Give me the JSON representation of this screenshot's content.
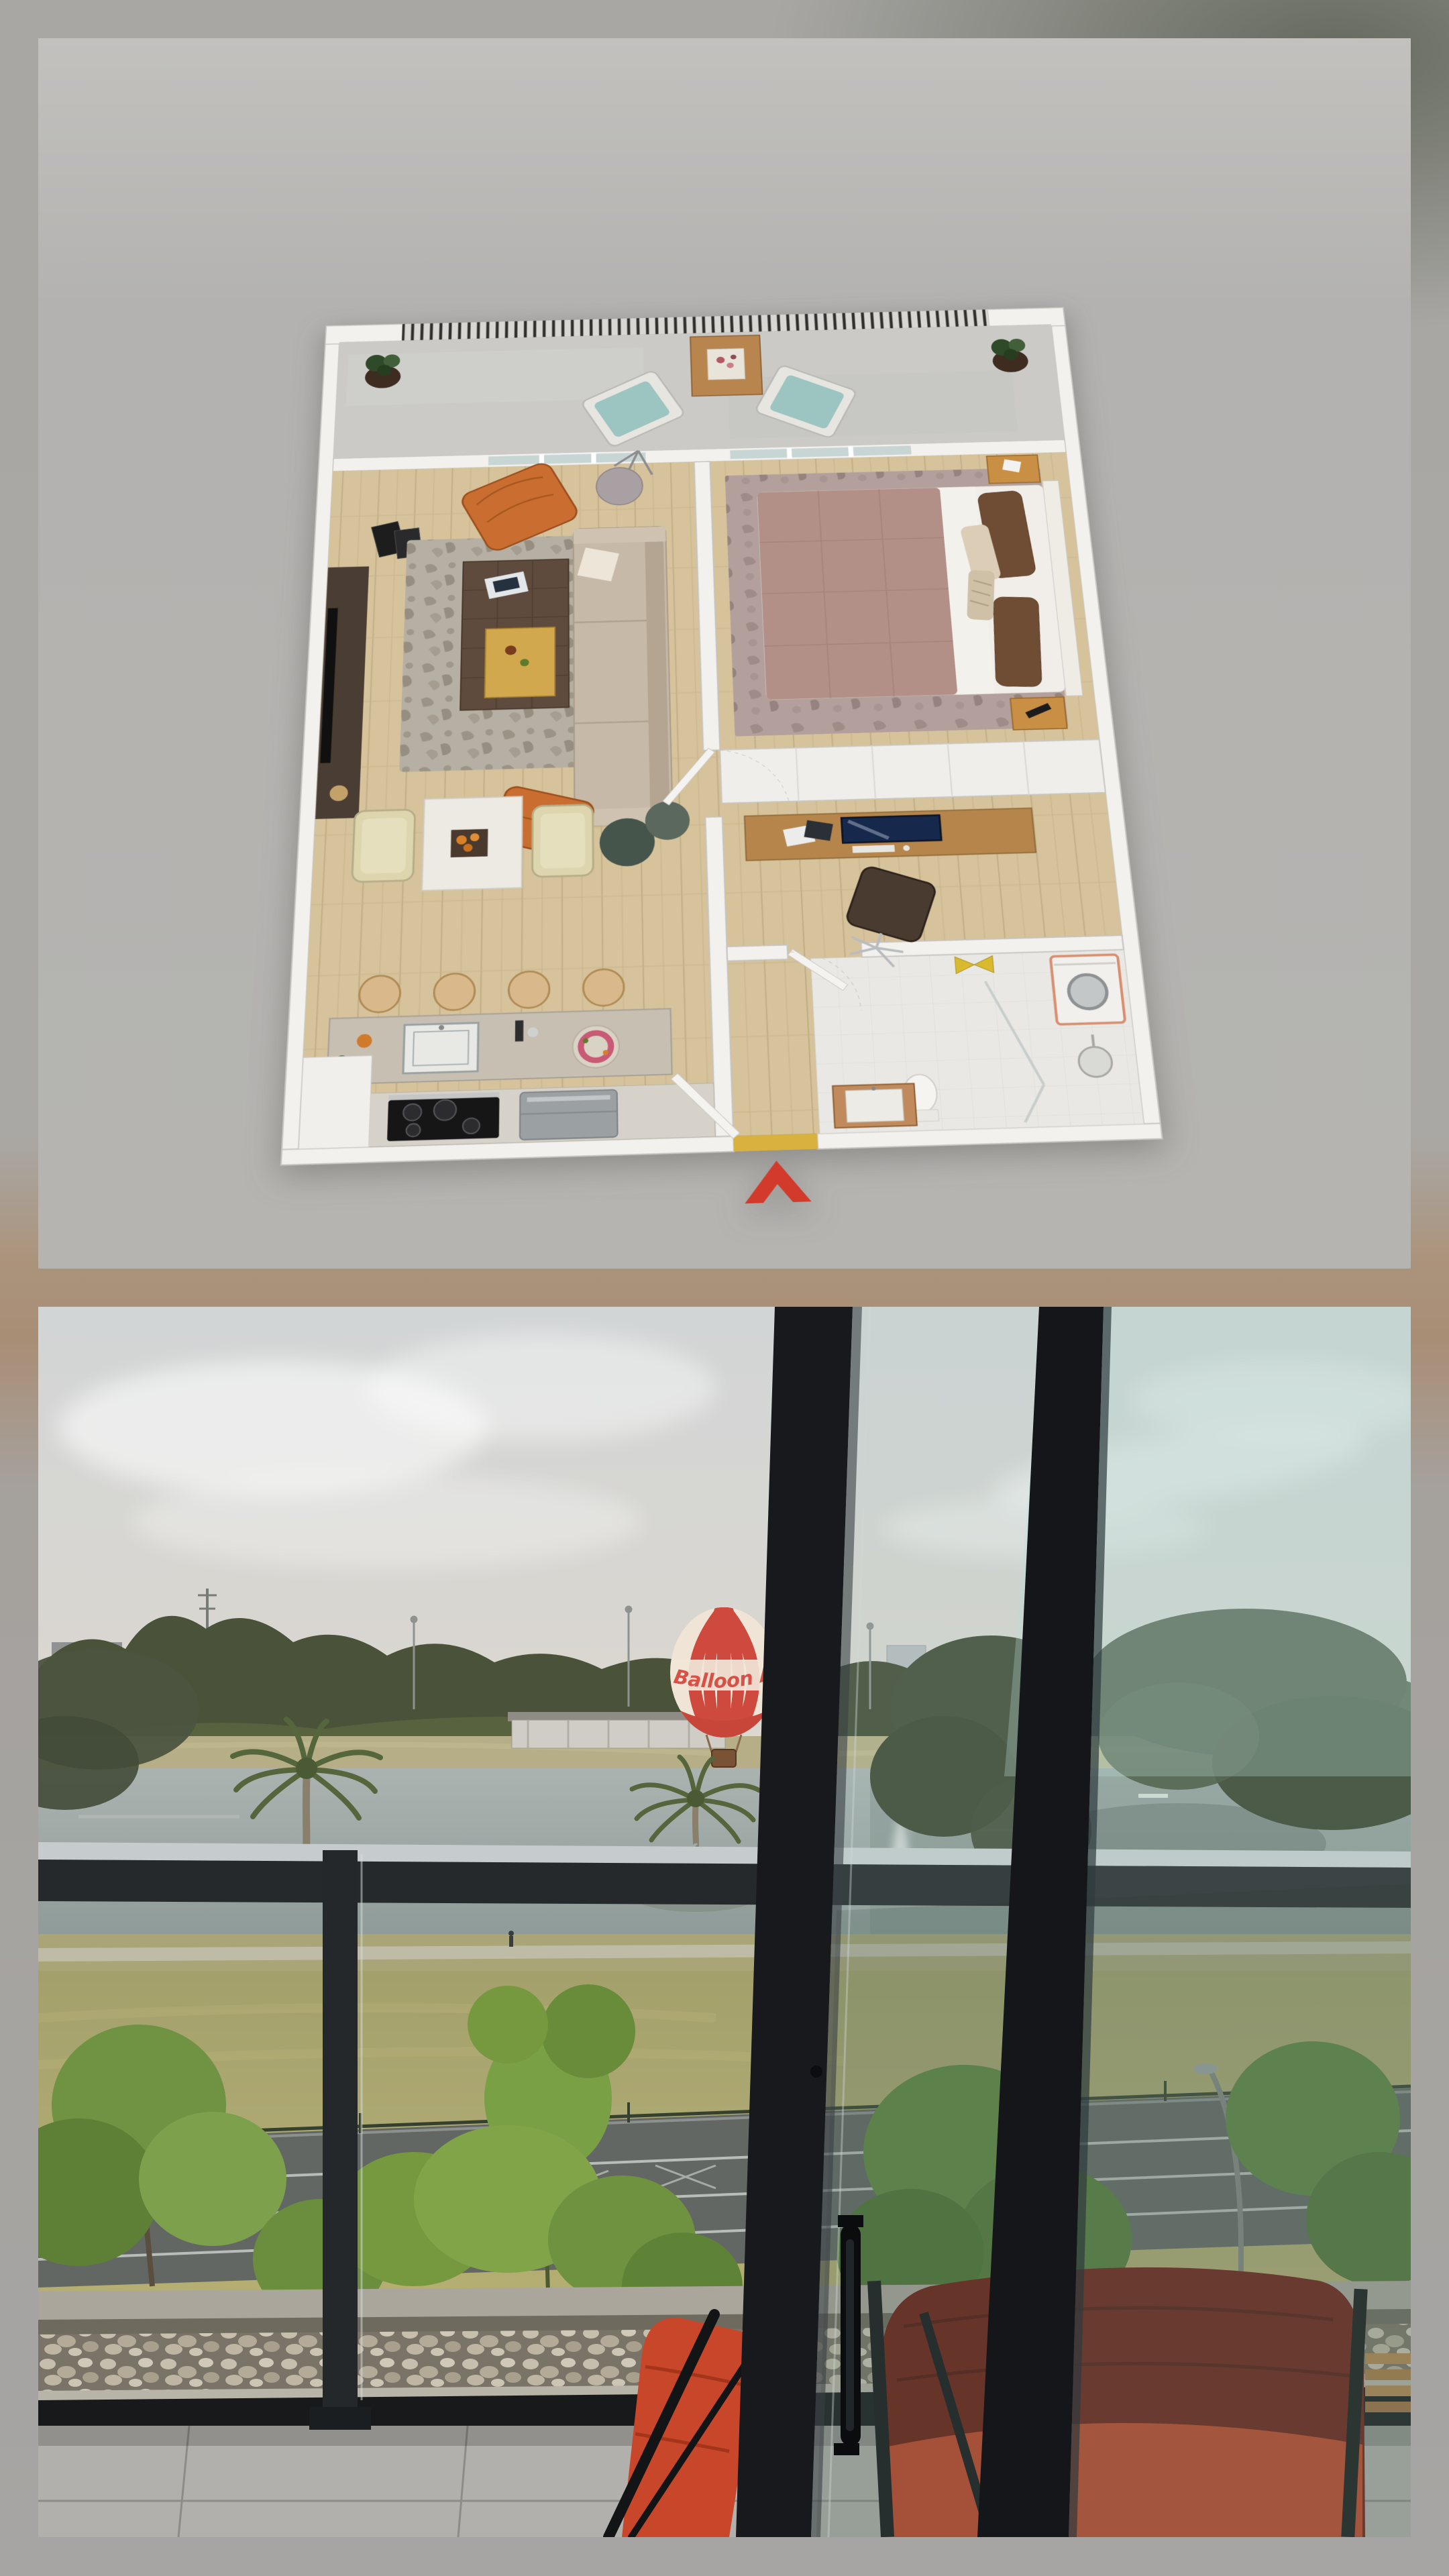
{
  "collage": {
    "layout": "two stacked photos on blurred grey-tan border",
    "photo_count": 2,
    "photos": [
      "3d-floor-plan-render",
      "balcony-park-lake-view"
    ]
  },
  "colors": {
    "plan_bg": "#b3b2af",
    "wall_white": "#f2f1ee",
    "wood_floor": "#d6c29b",
    "concrete_floor": "#cbcac6",
    "accent_orange": "#c96e30",
    "sofa_beige": "#c7b9a7",
    "coffee_table_brown": "#5e4b3d",
    "duvet_mauve": "#b29087",
    "pillow_brown": "#6f4c34",
    "nightstand_timber": "#c98f44",
    "desk_timber": "#b5854b",
    "stool_timber": "#d9b98c",
    "island_stone": "#c6bfb2",
    "teal_cushion": "#9cc4c0",
    "mat_yellow": "#d9b13e",
    "towel_yellow": "#d9ba2e",
    "arrow_red": "#d23a2c",
    "sky_grey": "#d4d6d6",
    "sky_warm": "#ded9d0",
    "glass_teal": "#9fc6bd",
    "treeline_green": "#474f38",
    "park_tree_green": "#6f9243",
    "grass_olive": "#a3a06b",
    "dry_grass": "#b5ae72",
    "lake_grey": "#a7b0ad",
    "road_grey": "#636763",
    "rail_dark": "#26292b",
    "frame_black": "#17191c",
    "balloon_red": "#ce4a3e",
    "balloon_cream": "#f0e4d6",
    "chair_red_bright": "#c8472a",
    "chair_red_shadow": "#6e1d12",
    "tile_grey": "#b2b0ad",
    "pebble_tan": "#c0b7a4"
  },
  "floor_plan": {
    "type": "3D isometric one-bedroom apartment floor plan",
    "entry_marker": "red chevron arrow pointing into entry at bottom",
    "rooms": [
      {
        "name": "balcony",
        "items": [
          "slatted railing",
          "potted plant left",
          "potted plant right",
          "two outdoor armchairs with teal cushions",
          "timber side table with white flower tray"
        ]
      },
      {
        "name": "living room",
        "items": [
          "dark TV unit on left wall",
          "flat-screen TV",
          "leaning picture frames",
          "patterned grey rug",
          "dark timber coffee table with magazines and brass tray",
          "beige sofa with white cushion",
          "orange lounge chair",
          "orange ottoman",
          "two dark-green poufs",
          "grey dome floor lamp"
        ]
      },
      {
        "name": "dining area",
        "items": [
          "white square table with fruit tray",
          "two cream tub chairs"
        ]
      },
      {
        "name": "kitchen",
        "items": [
          "stone island bench with sink, posy, bottle and platter",
          "small plant",
          "four round timber bar stools",
          "black cooktop",
          "grey appliance",
          "white cabinet"
        ]
      },
      {
        "name": "bedroom",
        "items": [
          "queen bed with dusty-pink quilt and folded white sheet",
          "brown and cream pillows",
          "white headboard",
          "timber nightstand with phone",
          "timber nightstand with remote",
          "dusty-pink patterned rug",
          "built-in wardrobe"
        ]
      },
      {
        "name": "study nook",
        "items": [
          "timber desk",
          "monitor",
          "keyboard",
          "papers",
          "laptop",
          "dark office chair"
        ]
      },
      {
        "name": "laundry",
        "items": [
          "washing machine with coral trim",
          "yellow towels"
        ]
      },
      {
        "name": "bathroom",
        "items": [
          "toilet",
          "timber vanity with basin",
          "glass shower screen",
          "round shower head"
        ]
      },
      {
        "name": "entry",
        "items": [
          "yellow door mat",
          "open entry door"
        ]
      }
    ]
  },
  "balcony_view": {
    "scene": "apartment balcony at dusk overlooking parkland lake",
    "balloon": {
      "text": "Balloon Air",
      "style": "red envelope with cream stripes, cream script band, wicker basket"
    },
    "background": [
      "overcast grey sky",
      "grey apartment slab and brick tower on left horizon",
      "white tower mid-right",
      "power masts far right",
      "dark treeline",
      "lakeside pavilion",
      "light poles",
      "lake with fountain plume and reflections",
      "two canary palms"
    ],
    "midground": [
      "glass balustrade with pale top rail, dark rail and black post",
      "parkland grass",
      "walking path with pedestrian",
      "road with white lane lines and wire fence",
      "curved street lamp",
      "bright green park trees"
    ],
    "foreground": [
      "black sliding-door frame",
      "door handle and lock",
      "black window mullion",
      "teal tinted glass panes",
      "concrete hob",
      "pebble drainage strip",
      "large grey floor tiles",
      "bright red fabric chair",
      "large shaded red fabric chair",
      "timber slat table edge"
    ]
  }
}
